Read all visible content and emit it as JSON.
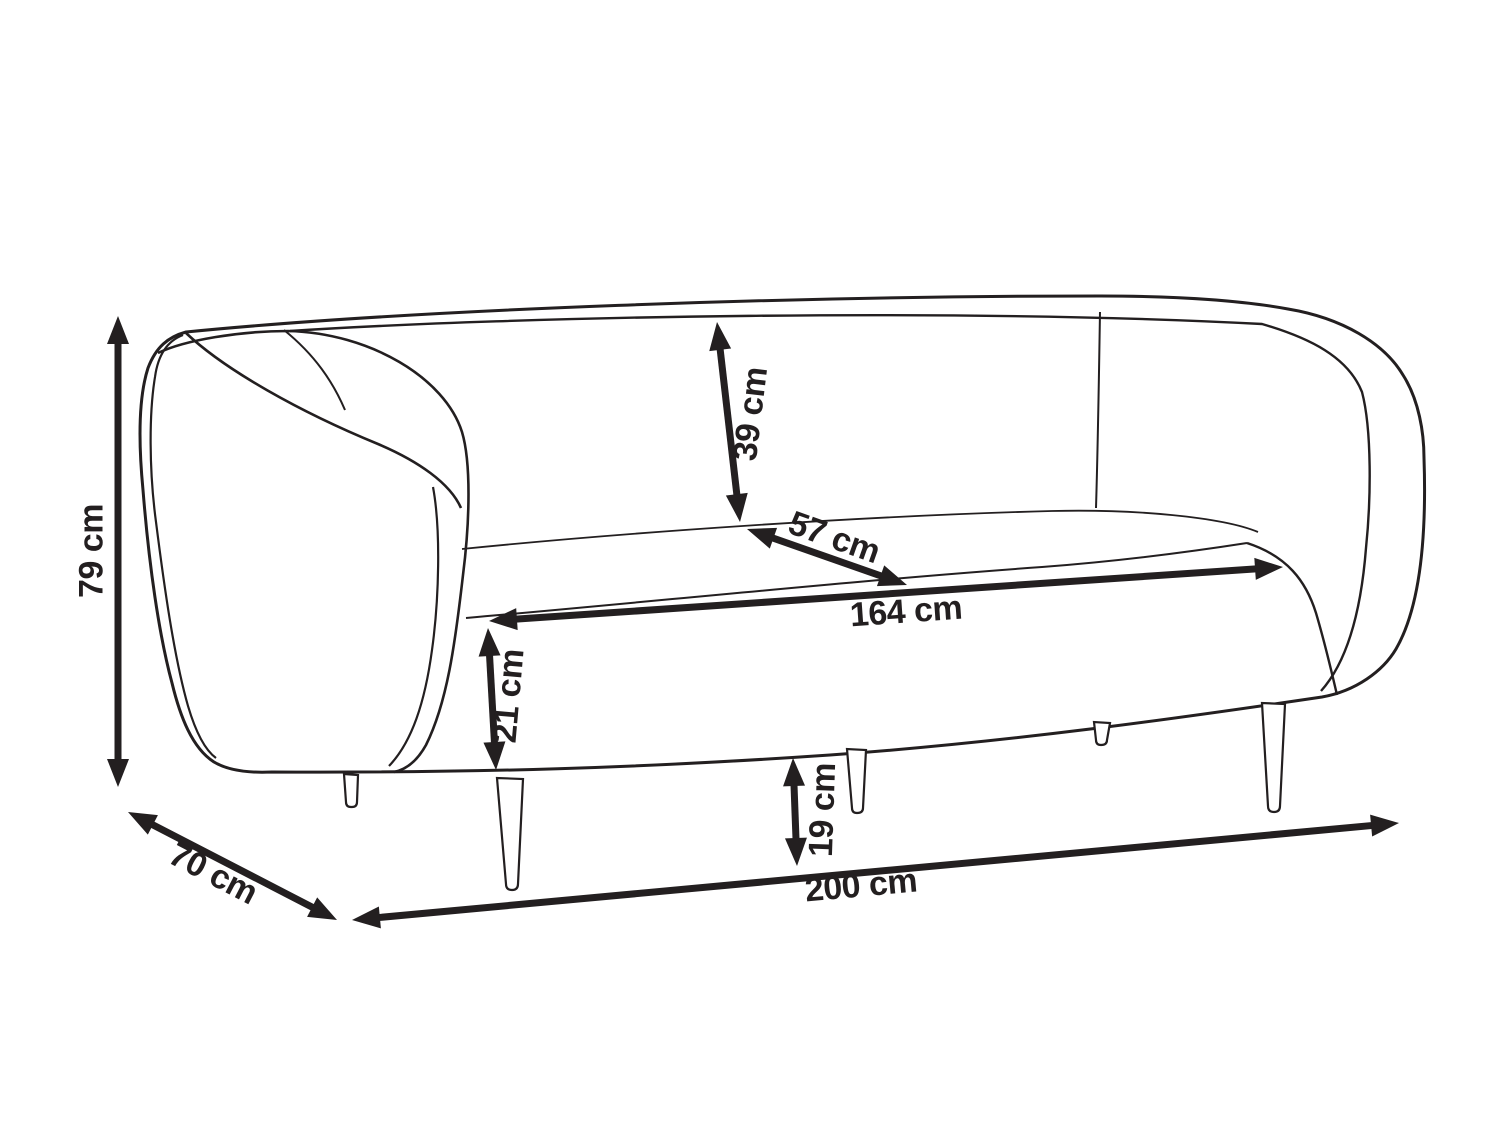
{
  "diagram": {
    "subject": "sofa-dimension-diagram",
    "unit": "cm",
    "colors": {
      "line": "#231f20",
      "background": "#ffffff"
    }
  },
  "dimensions": {
    "overall_height": {
      "label": "79 cm",
      "value": 79
    },
    "overall_depth": {
      "label": "70 cm",
      "value": 70
    },
    "overall_width": {
      "label": "200 cm",
      "value": 200
    },
    "seat_width": {
      "label": "164 cm",
      "value": 164
    },
    "seat_depth": {
      "label": "57 cm",
      "value": 57
    },
    "backrest_height": {
      "label": "39 cm",
      "value": 39
    },
    "seat_cushion_height": {
      "label": "21 cm",
      "value": 21
    },
    "leg_height": {
      "label": "19 cm",
      "value": 19
    }
  }
}
